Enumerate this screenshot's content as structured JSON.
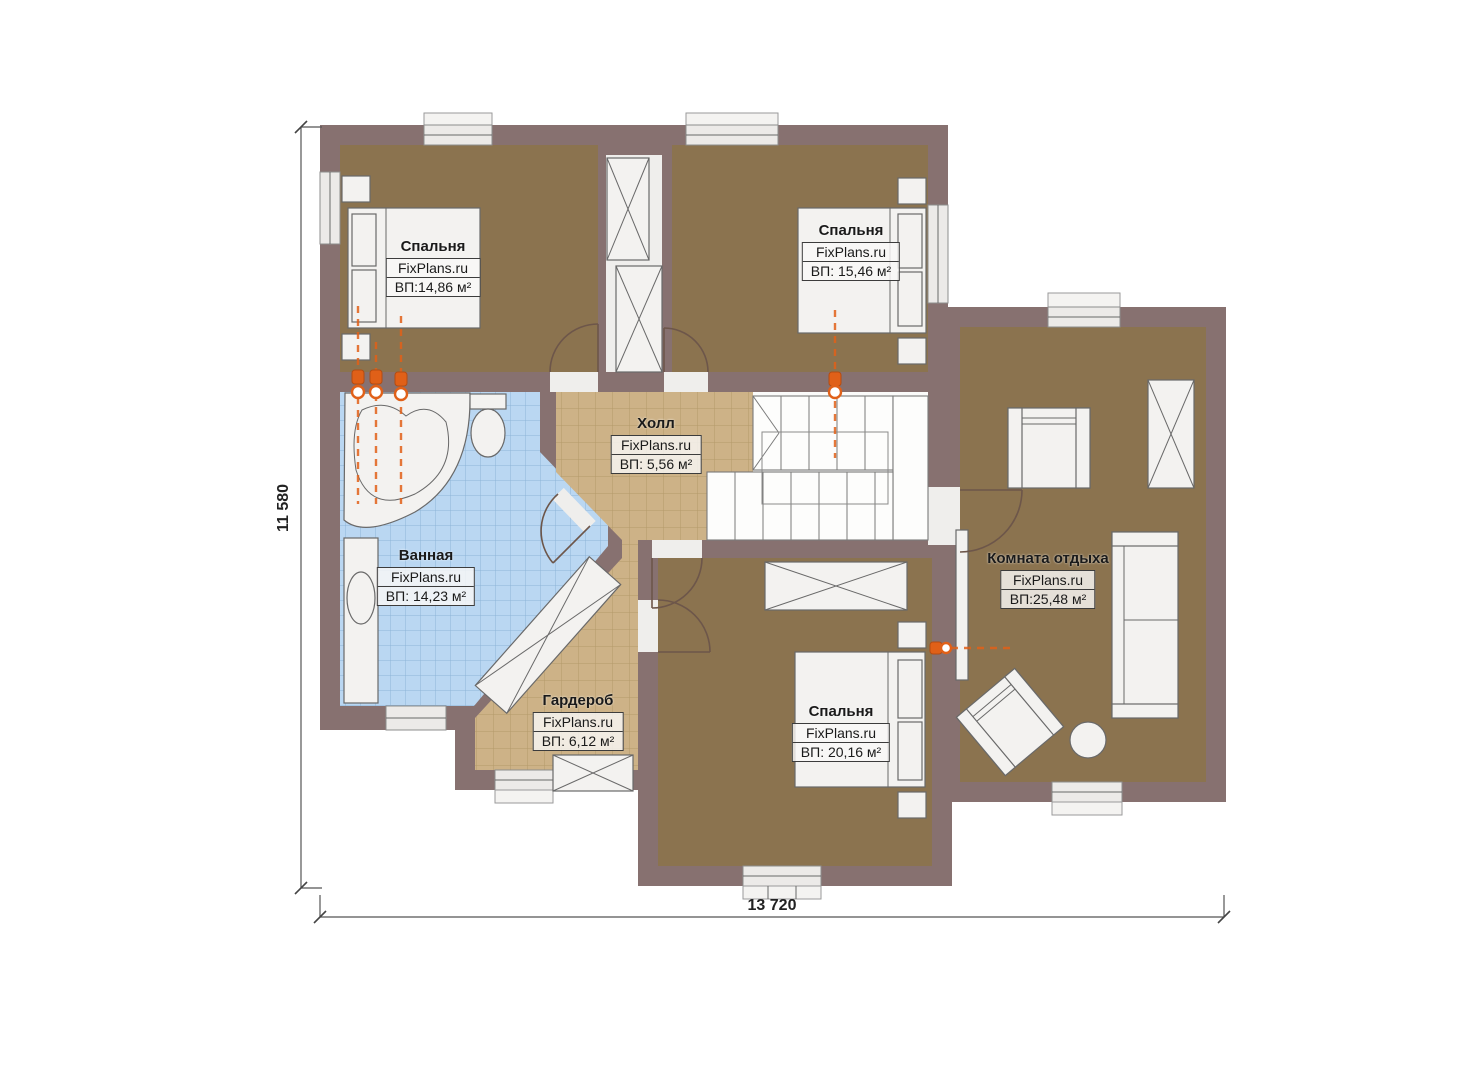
{
  "plan": {
    "title": "floor plan",
    "dimensions": {
      "height_label": "11 580",
      "width_label": "13 720"
    },
    "rooms": [
      {
        "name": "Спальня",
        "watermark": "FixPlans.ru",
        "area": "ВП:14,86 м²"
      },
      {
        "name": "Спальня",
        "watermark": "FixPlans.ru",
        "area": "ВП: 15,46 м²"
      },
      {
        "name": "Холл",
        "watermark": "FixPlans.ru",
        "area": "ВП: 5,56 м²"
      },
      {
        "name": "Ванная",
        "watermark": "FixPlans.ru",
        "area": "ВП: 14,23 м²"
      },
      {
        "name": "Гардероб",
        "watermark": "FixPlans.ru",
        "area": "ВП: 6,12 м²"
      },
      {
        "name": "Спальня",
        "watermark": "FixPlans.ru",
        "area": "ВП: 20,16 м²"
      },
      {
        "name": "Комната отдыха",
        "watermark": "FixPlans.ru",
        "area": "ВП:25,48 м²"
      }
    ]
  },
  "colors": {
    "wall": "#877170",
    "floor_brown": "#8b734f",
    "tile_tan": "#cdb287",
    "tile_blue": "#bad7f2",
    "accent_orange": "#e06018"
  }
}
